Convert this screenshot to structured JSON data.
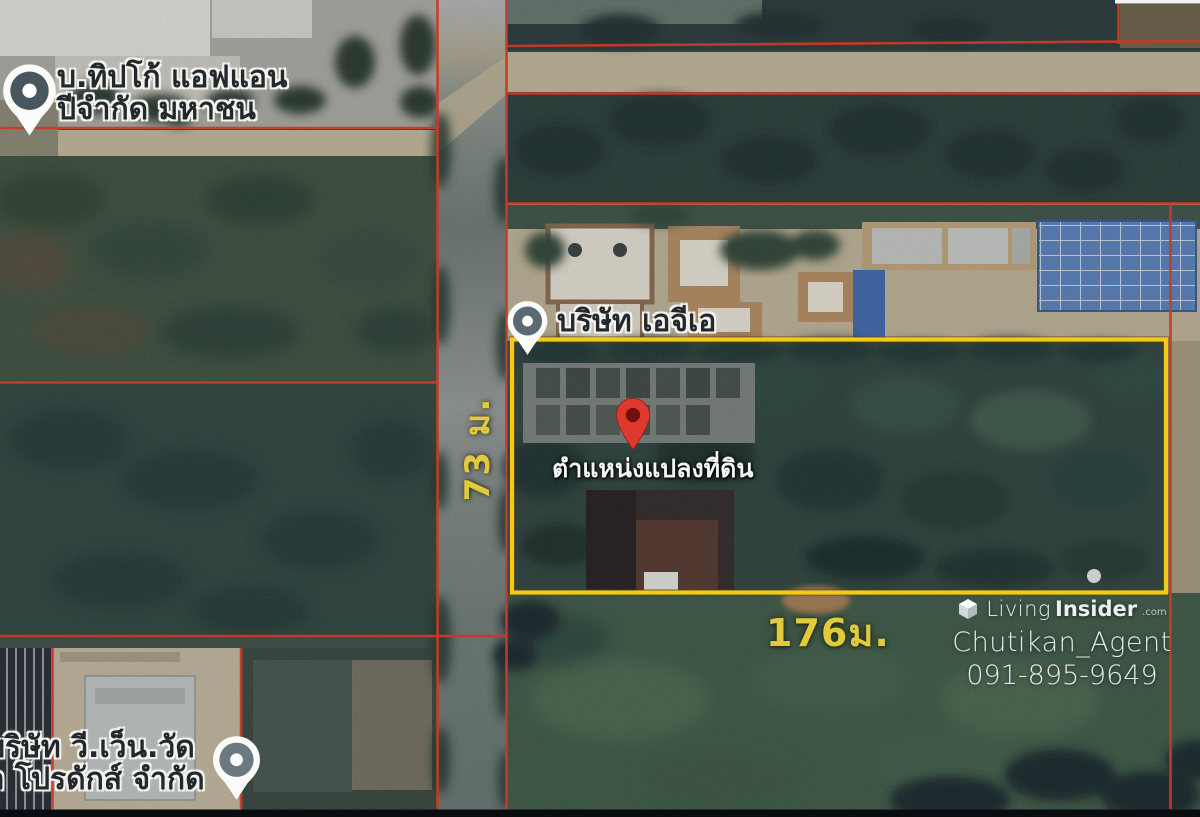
{
  "map": {
    "labels": {
      "company_top_left_line1": "บ.ทิปโก้ แอฟแอน",
      "company_top_left_line2": "ปีจำกัด มหาชน",
      "company_center": "บริษัท เอจีเอ",
      "company_bottom_left_line1": "บริษัท วี.เว็น.วัด",
      "company_bottom_left_line2": "ล โปรดักส์ จำกัด",
      "plot_marker": "ตำแหน่งแปลงที่ดิน"
    },
    "measurements": {
      "frontage": "176ม.",
      "depth": "73 ม."
    },
    "colors": {
      "plot_outline": "#F1CC17",
      "parcel_lines": "#C8392A",
      "measurement_text": "#E2CB3A",
      "location_pin": "#DF382C"
    }
  },
  "watermark": {
    "brand_first": "Living",
    "brand_second": "Insider",
    "brand_tld": ".com",
    "agent_name": "Chutikan_Agent",
    "phone": "091-895-9649"
  }
}
